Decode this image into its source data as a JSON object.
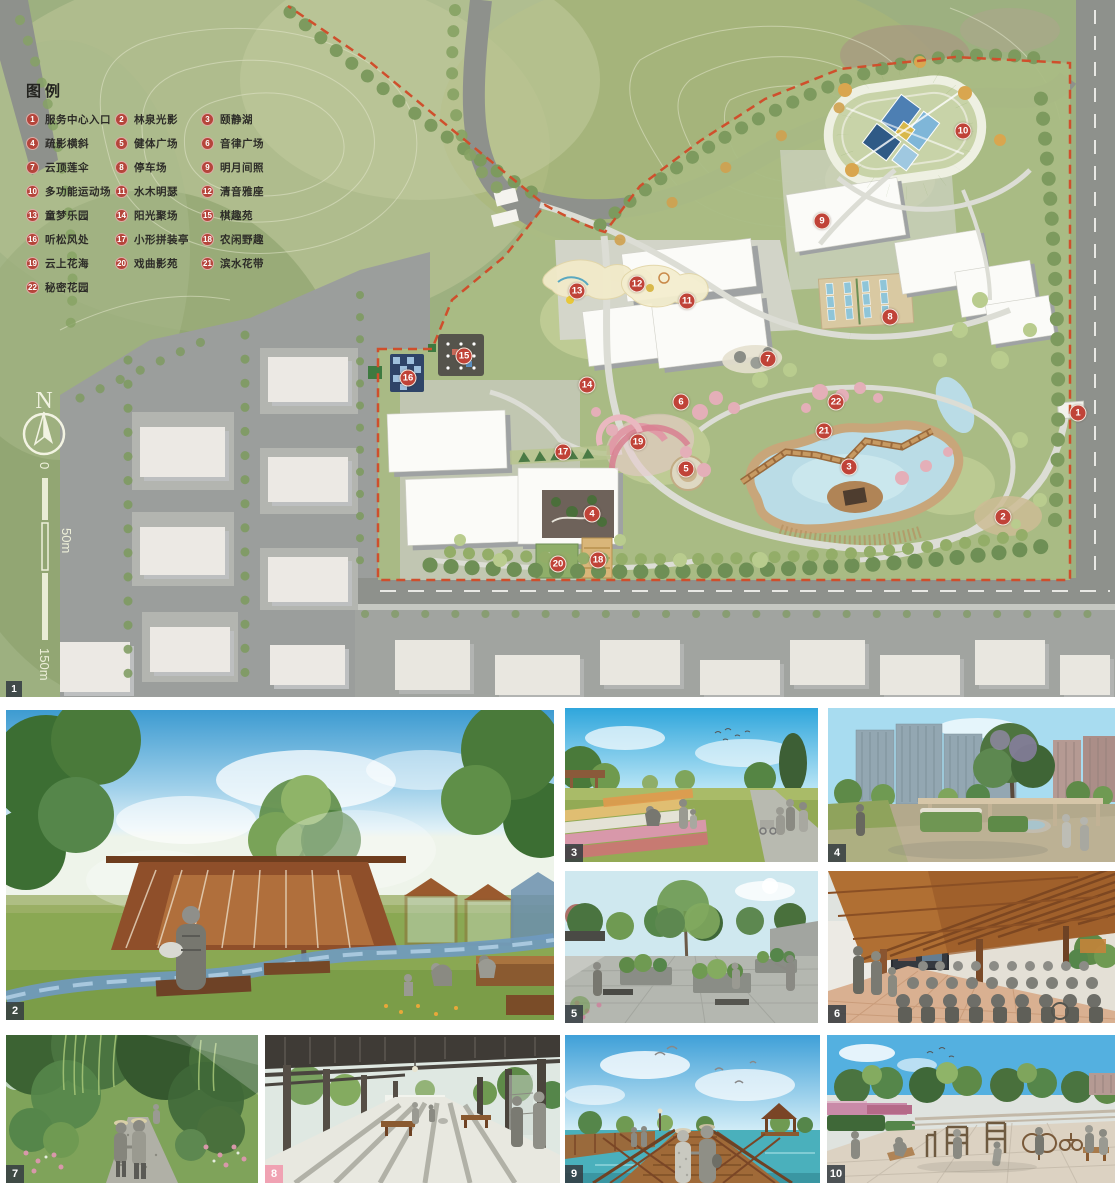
{
  "legend": {
    "title": "图例",
    "items": [
      {
        "num": "1",
        "label": "服务中心入口"
      },
      {
        "num": "2",
        "label": "林泉光影"
      },
      {
        "num": "3",
        "label": "颐静湖"
      },
      {
        "num": "4",
        "label": "疏影横斜"
      },
      {
        "num": "5",
        "label": "健体广场"
      },
      {
        "num": "6",
        "label": "音律广场"
      },
      {
        "num": "7",
        "label": "云顶莲伞"
      },
      {
        "num": "8",
        "label": "停车场"
      },
      {
        "num": "9",
        "label": "明月间照"
      },
      {
        "num": "10",
        "label": "多功能运动场"
      },
      {
        "num": "11",
        "label": "水木明瑟"
      },
      {
        "num": "12",
        "label": "清音雅座"
      },
      {
        "num": "13",
        "label": "童梦乐园"
      },
      {
        "num": "14",
        "label": "阳光聚场"
      },
      {
        "num": "15",
        "label": "棋趣苑"
      },
      {
        "num": "16",
        "label": "听松风处"
      },
      {
        "num": "17",
        "label": "小形拼装亭"
      },
      {
        "num": "18",
        "label": "农闲野趣"
      },
      {
        "num": "19",
        "label": "云上花海"
      },
      {
        "num": "20",
        "label": "戏曲影苑"
      },
      {
        "num": "21",
        "label": "滨水花带"
      },
      {
        "num": "22",
        "label": "秘密花园"
      }
    ]
  },
  "compass": {
    "label": "N"
  },
  "scalebar": {
    "zero": "0",
    "mid": "50m",
    "end": "150m"
  },
  "plan": {
    "corner_badge": "1",
    "markers": [
      {
        "n": "1",
        "x": 1078,
        "y": 413
      },
      {
        "n": "2",
        "x": 1003,
        "y": 517
      },
      {
        "n": "3",
        "x": 849,
        "y": 467
      },
      {
        "n": "4",
        "x": 592,
        "y": 514
      },
      {
        "n": "5",
        "x": 686,
        "y": 469
      },
      {
        "n": "6",
        "x": 681,
        "y": 402
      },
      {
        "n": "7",
        "x": 768,
        "y": 359
      },
      {
        "n": "8",
        "x": 890,
        "y": 317
      },
      {
        "n": "9",
        "x": 822,
        "y": 221
      },
      {
        "n": "10",
        "x": 963,
        "y": 131
      },
      {
        "n": "11",
        "x": 687,
        "y": 301
      },
      {
        "n": "12",
        "x": 637,
        "y": 284
      },
      {
        "n": "13",
        "x": 577,
        "y": 291
      },
      {
        "n": "14",
        "x": 587,
        "y": 385
      },
      {
        "n": "15",
        "x": 464,
        "y": 356
      },
      {
        "n": "16",
        "x": 408,
        "y": 378
      },
      {
        "n": "17",
        "x": 563,
        "y": 452
      },
      {
        "n": "18",
        "x": 598,
        "y": 560
      },
      {
        "n": "19",
        "x": 638,
        "y": 442
      },
      {
        "n": "20",
        "x": 558,
        "y": 564
      },
      {
        "n": "21",
        "x": 824,
        "y": 431
      },
      {
        "n": "22",
        "x": 836,
        "y": 402
      }
    ]
  },
  "photos": [
    {
      "num": "2"
    },
    {
      "num": "3"
    },
    {
      "num": "4"
    },
    {
      "num": "5"
    },
    {
      "num": "6"
    },
    {
      "num": "7"
    },
    {
      "num": "8"
    },
    {
      "num": "9"
    },
    {
      "num": "10"
    }
  ],
  "colors": {
    "marker_red": "#c04338",
    "boundary_red": "#cf4f2c",
    "badge_dark": "#343c42",
    "badge_pink": "#f09baf",
    "water": "#badce6",
    "court_blue": "#4d7fb3"
  }
}
